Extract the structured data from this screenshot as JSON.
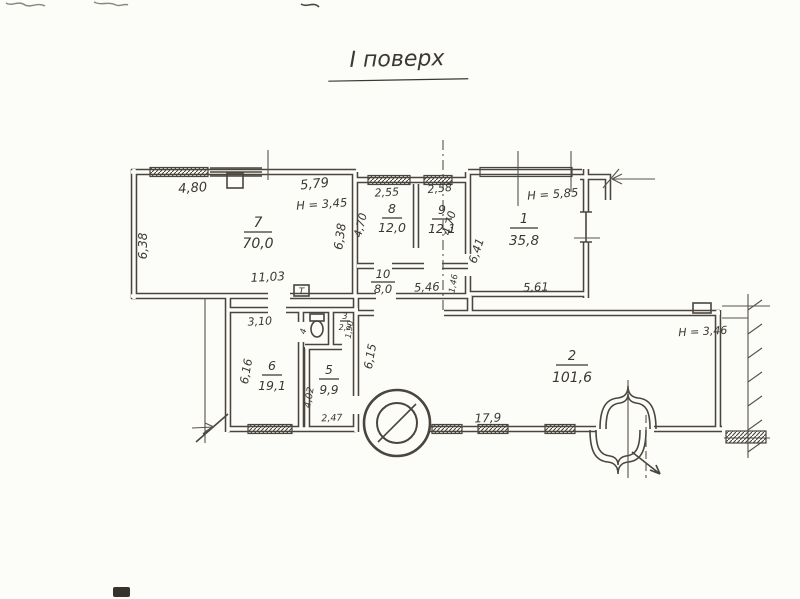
{
  "title": "І поверх",
  "rooms": {
    "r1": {
      "number": "1",
      "area": "35,8",
      "height": "Н = 5,85"
    },
    "r2": {
      "number": "2",
      "area": "101,6",
      "height": "Н = 3,46"
    },
    "r3": {
      "number": "3",
      "area": "2,2"
    },
    "r4": {
      "number": "4"
    },
    "r5": {
      "number": "5",
      "area": "9,9"
    },
    "r6": {
      "number": "6",
      "area": "19,1"
    },
    "r7": {
      "number": "7",
      "area": "70,0",
      "height": "Н = 3,45"
    },
    "r8": {
      "number": "8",
      "area": "12,0"
    },
    "r9": {
      "number": "9",
      "area": "12,1"
    },
    "r10": {
      "number": "10",
      "area": "8,0"
    }
  },
  "dimensions": {
    "d480": "4,80",
    "d579": "5,79",
    "d638_left": "6,38",
    "d638_mid": "6,38",
    "d1103": "11,03",
    "d255": "2,55",
    "d258": "2,58",
    "d470_left": "4,70",
    "d470_right": "4,70",
    "d641": "6,41",
    "d561": "5,61",
    "d546": "5,46",
    "d146": "1,46",
    "d310": "3,10",
    "d616": "6,16",
    "d402": "4,02",
    "d247": "2,47",
    "d190": "1,90",
    "d615": "6,15",
    "d179": "17,9"
  },
  "symbols": {
    "t_box": "Т"
  },
  "colors": {
    "ink": "#4a463d",
    "paper": "#fcfcf9",
    "text": "#3b382f"
  }
}
